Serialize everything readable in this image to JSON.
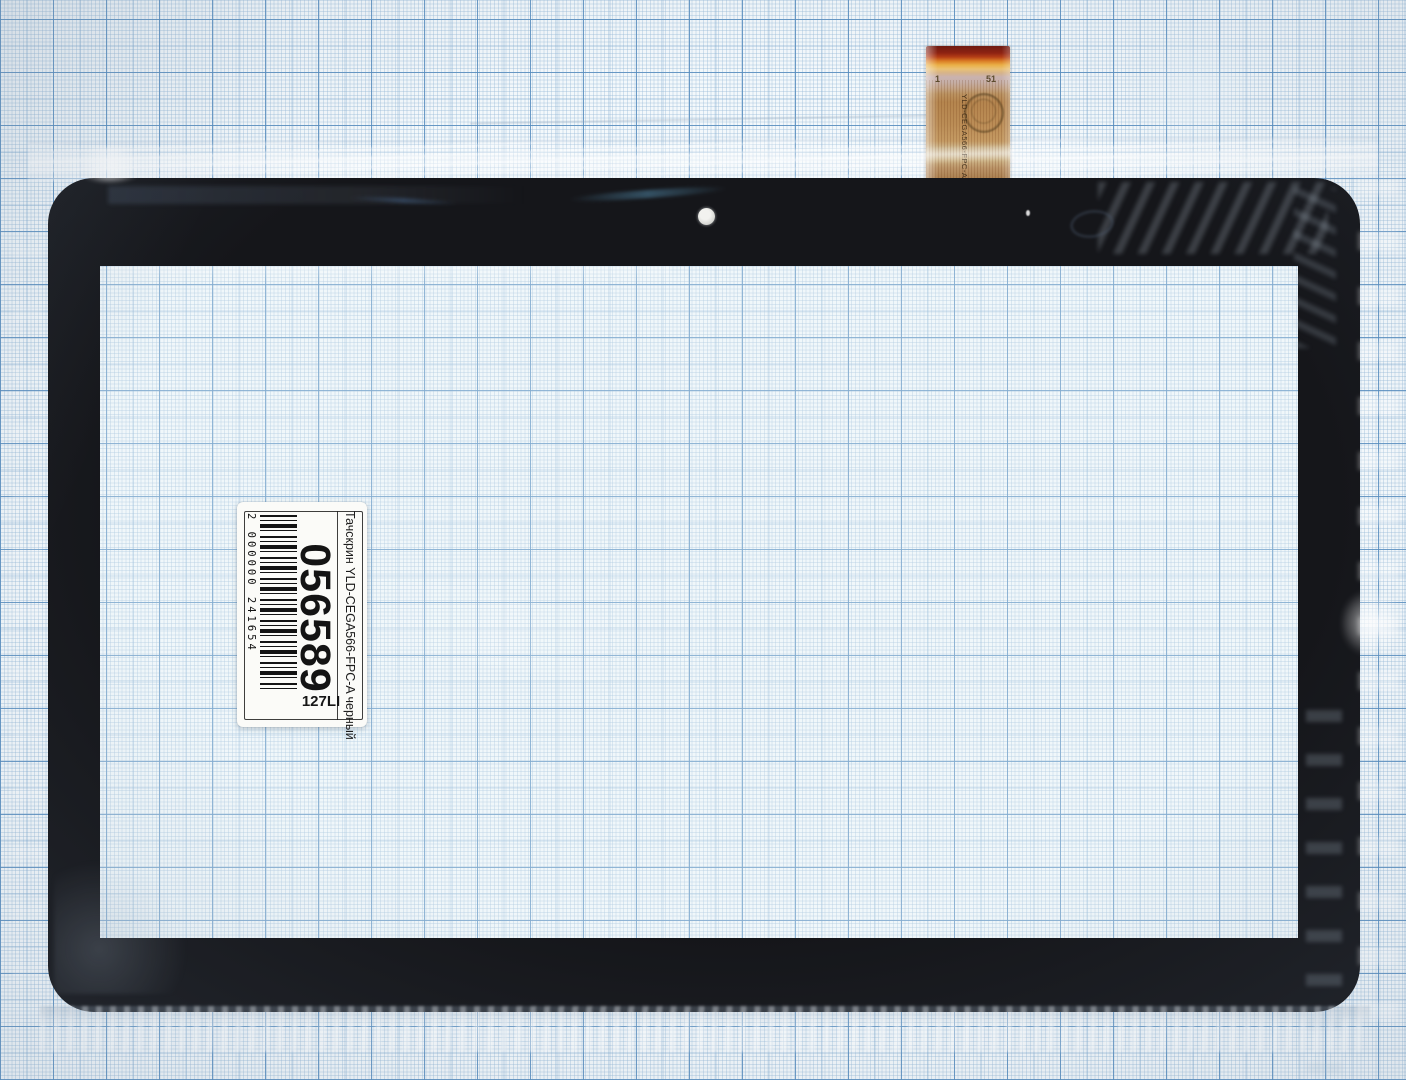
{
  "scene": {
    "description": "Photo of a black tablet touchscreen digitizer lying on blue millimeter graph paper, wrapped in clear film",
    "paper_color": "#f3f8fb",
    "grid_bold_color": "#568cbe",
    "grid_medium_color": "#78a5cd",
    "grid_minor_color": "#96b9d7",
    "frame_color": "#15161a",
    "cable_color": "#b5854e",
    "sticker_color": "#fbfbf8"
  },
  "sticker": {
    "barcode_digits": "2 000000 241654",
    "serial_number": "056589",
    "batch_code": "127LI",
    "description": "Тачскрин YLD-CEGA566-FPC-A черный"
  },
  "cable": {
    "pin_first": "1",
    "pin_last": "51",
    "model": "YLD-CEGA566-FPC-A0"
  }
}
